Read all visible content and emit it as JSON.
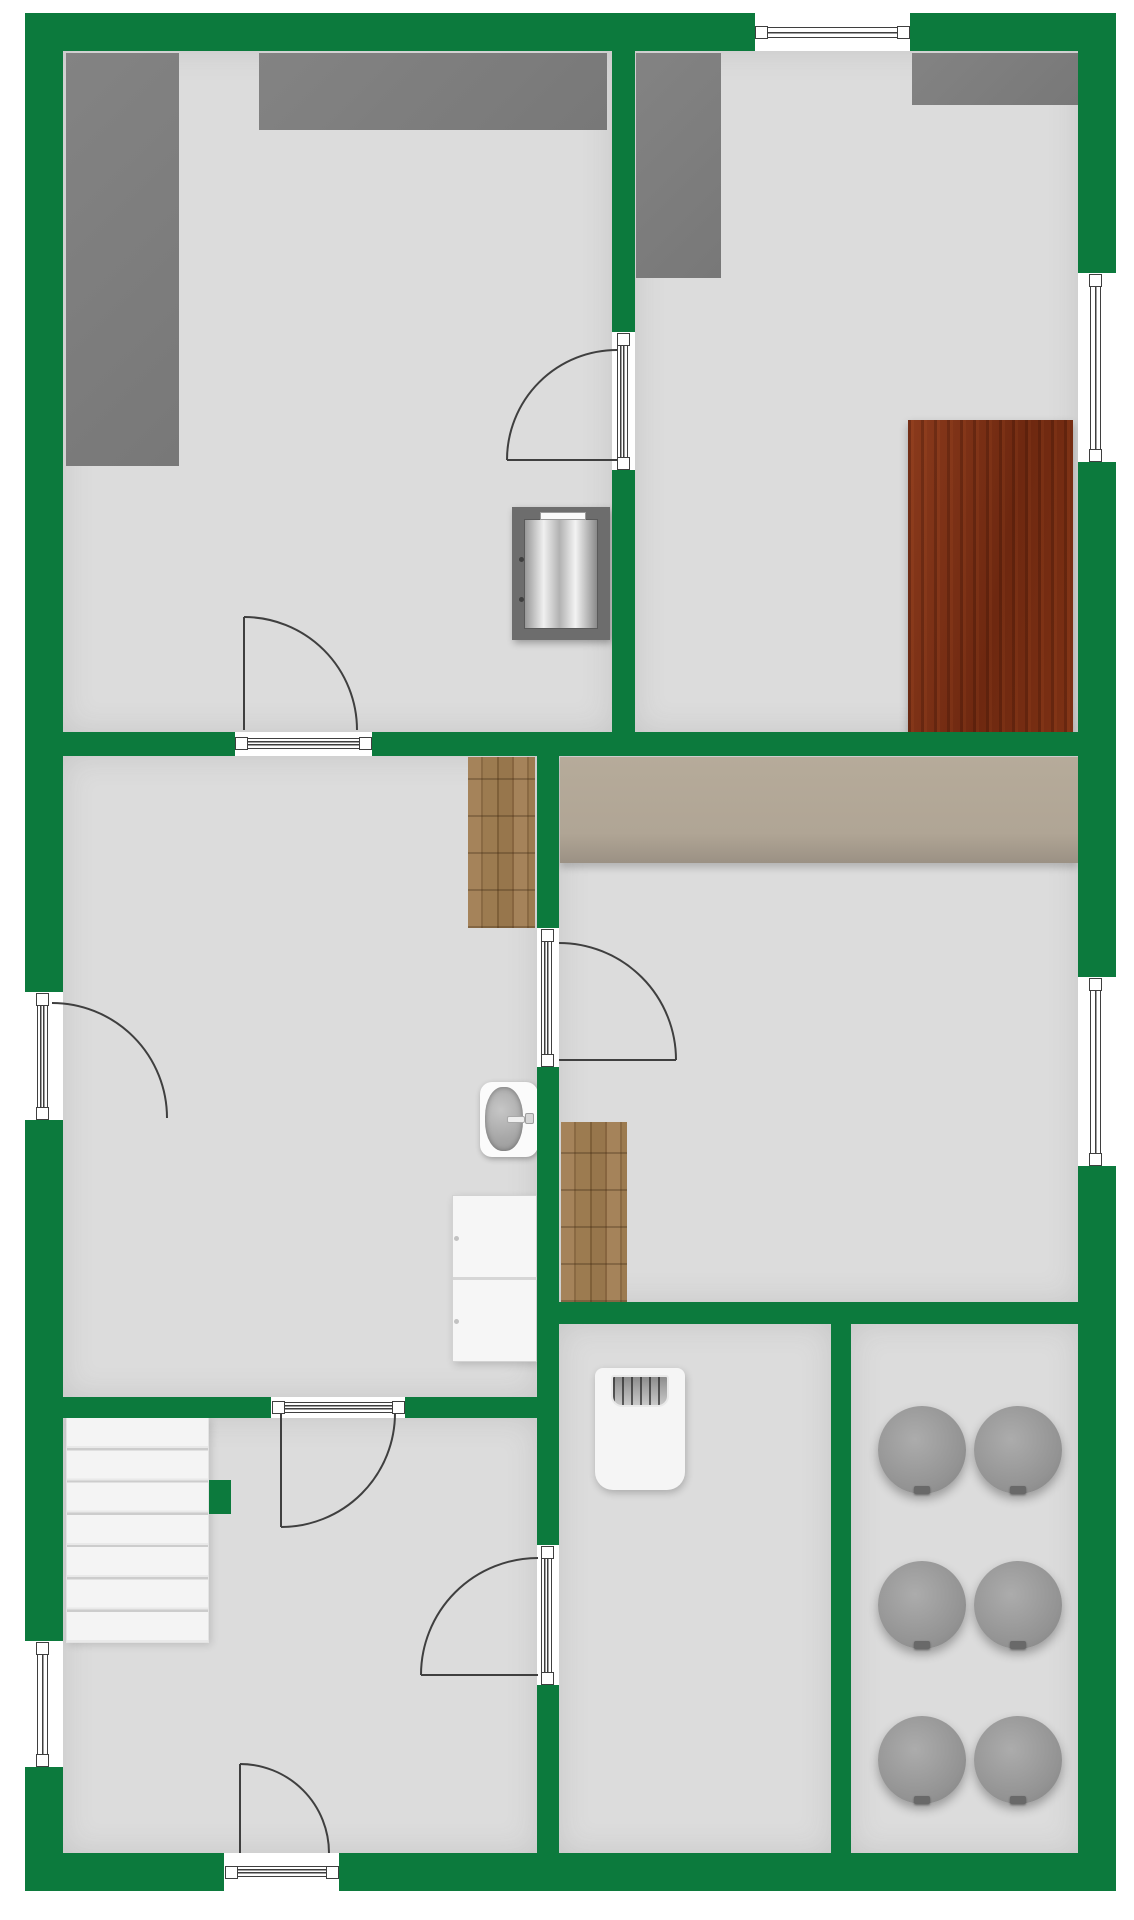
{
  "canvas": {
    "width": 1134,
    "height": 1920,
    "background": "#ffffff"
  },
  "colors": {
    "wall": "#0c7a3d",
    "floor": "#dcdcdc",
    "line": "#3f3f3f",
    "counter_gray": "#7b7b7b",
    "worktop_beige": "#b3a897",
    "wood_floor": "#9a7a50",
    "table_mahogany": "#7c2f14",
    "stool_gray": "#9a9a9a",
    "stairs_white": "#f2f2f2"
  },
  "rooms": [
    {
      "name": "room-top-left-floor",
      "x": 63,
      "y": 51,
      "w": 549,
      "h": 681
    },
    {
      "name": "room-top-right-floor",
      "x": 635,
      "y": 51,
      "w": 443,
      "h": 681
    },
    {
      "name": "room-middle-left-floor",
      "x": 63,
      "y": 756,
      "w": 474,
      "h": 641
    },
    {
      "name": "room-middle-right-floor",
      "x": 559,
      "y": 756,
      "w": 519,
      "h": 546
    },
    {
      "name": "room-bottom-left-floor",
      "x": 63,
      "y": 1418,
      "w": 474,
      "h": 435
    },
    {
      "name": "room-bottom-middle-floor",
      "x": 559,
      "y": 1324,
      "w": 272,
      "h": 529
    },
    {
      "name": "room-bottom-right-floor",
      "x": 851,
      "y": 1324,
      "w": 227,
      "h": 529
    }
  ],
  "walls": [
    {
      "name": "wall-outer-top",
      "x": 25,
      "y": 13,
      "w": 1091,
      "h": 38
    },
    {
      "name": "wall-outer-left",
      "x": 25,
      "y": 13,
      "w": 38,
      "h": 1878
    },
    {
      "name": "wall-outer-right",
      "x": 1078,
      "y": 13,
      "w": 38,
      "h": 1878
    },
    {
      "name": "wall-outer-bottom",
      "x": 25,
      "y": 1853,
      "w": 1091,
      "h": 38
    },
    {
      "name": "wall-middle-horizontal",
      "x": 63,
      "y": 732,
      "w": 1015,
      "h": 24
    },
    {
      "name": "wall-divider-top",
      "x": 612,
      "y": 51,
      "w": 23,
      "h": 681
    },
    {
      "name": "wall-divider-middle",
      "x": 537,
      "y": 756,
      "w": 22,
      "h": 1097
    },
    {
      "name": "wall-lower-left-horizontal",
      "x": 63,
      "y": 1397,
      "w": 474,
      "h": 21
    },
    {
      "name": "wall-lower-right-horizontal",
      "x": 559,
      "y": 1302,
      "w": 519,
      "h": 22
    },
    {
      "name": "wall-bottom-divider",
      "x": 831,
      "y": 1324,
      "w": 20,
      "h": 529
    },
    {
      "name": "wall-stair-stub",
      "x": 209,
      "y": 1480,
      "w": 22,
      "h": 34
    }
  ],
  "openings": [
    {
      "name": "window-top-wall",
      "kind": "window",
      "gap": [
        755,
        13,
        155,
        38
      ],
      "band": [
        755,
        27,
        155,
        11
      ],
      "posts": [
        [
          755,
          26
        ],
        [
          897,
          26
        ]
      ]
    },
    {
      "name": "window-right-wall-upper",
      "kind": "window",
      "gap": [
        1078,
        273,
        38,
        189
      ],
      "band": [
        1090,
        274,
        11,
        187
      ],
      "posts": [
        [
          1089,
          274
        ],
        [
          1089,
          449
        ]
      ]
    },
    {
      "name": "window-right-wall-lower",
      "kind": "window",
      "gap": [
        1078,
        977,
        38,
        189
      ],
      "band": [
        1090,
        978,
        11,
        187
      ],
      "posts": [
        [
          1089,
          978
        ],
        [
          1089,
          1153
        ]
      ]
    },
    {
      "name": "window-left-wall-lower",
      "kind": "window",
      "gap": [
        25,
        1641,
        38,
        126
      ],
      "band": [
        37,
        1642,
        11,
        124
      ],
      "posts": [
        [
          36,
          1642
        ],
        [
          36,
          1754
        ]
      ]
    },
    {
      "name": "door-window-left-wall",
      "kind": "door",
      "gap": [
        25,
        992,
        38,
        128
      ],
      "band": [
        37,
        993,
        11,
        126
      ],
      "posts": [
        [
          36,
          993
        ],
        [
          36,
          1107
        ]
      ],
      "arc": "M52,1003 A115,115 0 0 1 167,1118"
    },
    {
      "name": "door-top-divider",
      "kind": "door",
      "gap": [
        612,
        332,
        23,
        138
      ],
      "band": [
        617,
        334,
        11,
        134
      ],
      "posts": [
        [
          617,
          333
        ],
        [
          617,
          457
        ]
      ],
      "arc": "M507,460 A110,110 0 0 1 617,350",
      "leaf": "M617,460 L507,460"
    },
    {
      "name": "door-middle-wall",
      "kind": "door",
      "gap": [
        235,
        732,
        137,
        24
      ],
      "band": [
        237,
        738,
        133,
        11
      ],
      "posts": [
        [
          235,
          737
        ],
        [
          359,
          737
        ]
      ],
      "arc": "M244,617 A113,113 0 0 1 357,730",
      "leaf": "M244,730 L244,617"
    },
    {
      "name": "door-middle-divider-upper",
      "kind": "door",
      "gap": [
        537,
        928,
        22,
        139
      ],
      "band": [
        541,
        930,
        11,
        135
      ],
      "posts": [
        [
          541,
          929
        ],
        [
          541,
          1054
        ]
      ],
      "arc": "M559,943 A117,117 0 0 1 676,1060",
      "leaf": "M559,1060 L676,1060"
    },
    {
      "name": "door-middle-divider-lower",
      "kind": "door",
      "gap": [
        537,
        1545,
        22,
        140
      ],
      "band": [
        541,
        1547,
        11,
        136
      ],
      "posts": [
        [
          541,
          1546
        ],
        [
          541,
          1672
        ]
      ],
      "arc": "M538,1558 A117,117 0 0 0 421,1675",
      "leaf": "M538,1675 L421,1675"
    },
    {
      "name": "door-lower-left-wall",
      "kind": "door",
      "gap": [
        271,
        1397,
        134,
        21
      ],
      "band": [
        273,
        1402,
        130,
        11
      ],
      "posts": [
        [
          272,
          1401
        ],
        [
          392,
          1401
        ]
      ],
      "arc": "M281,1527 A114,114 0 0 0 395,1413",
      "leaf": "M281,1413 L281,1527"
    },
    {
      "name": "door-bottom-wall-entrance",
      "kind": "door",
      "gap": [
        224,
        1853,
        115,
        38
      ],
      "band": [
        226,
        1866,
        111,
        11
      ],
      "posts": [
        [
          225,
          1866
        ],
        [
          326,
          1866
        ]
      ],
      "arc": "M240,1764 A89,89 0 0 1 329,1853",
      "leaf": "M240,1853 L240,1764"
    }
  ],
  "furniture": [
    {
      "name": "counter-top-left-vertical",
      "type": "counter",
      "x": 66,
      "y": 53,
      "w": 113,
      "h": 413
    },
    {
      "name": "counter-top-left-horizontal",
      "type": "counter",
      "x": 259,
      "y": 53,
      "w": 348,
      "h": 77
    },
    {
      "name": "counter-top-right-vertical",
      "type": "counter",
      "x": 636,
      "y": 53,
      "w": 85,
      "h": 225
    },
    {
      "name": "counter-top-right-horizontal",
      "type": "counter",
      "x": 912,
      "y": 53,
      "w": 166,
      "h": 52
    },
    {
      "name": "dining-table",
      "type": "table",
      "x": 908,
      "y": 420,
      "w": 165,
      "h": 312
    },
    {
      "name": "stove",
      "type": "stove",
      "x": 512,
      "y": 507,
      "w": 98,
      "h": 133
    },
    {
      "name": "worktop-beige",
      "type": "beige",
      "x": 560,
      "y": 757,
      "w": 518,
      "h": 106
    },
    {
      "name": "wood-floor-strip-upper",
      "type": "wood",
      "x": 468,
      "y": 757,
      "w": 67,
      "h": 171
    },
    {
      "name": "wood-floor-strip-lower",
      "type": "wood",
      "x": 561,
      "y": 1122,
      "w": 66,
      "h": 180
    },
    {
      "name": "wash-basin",
      "type": "sink",
      "x": 480,
      "y": 1082,
      "w": 58,
      "h": 75
    },
    {
      "name": "cabinet",
      "type": "cabinet",
      "x": 452,
      "y": 1195,
      "w": 85,
      "h": 167
    },
    {
      "name": "staircase",
      "type": "stairs",
      "x": 66,
      "y": 1417,
      "w": 143,
      "h": 226
    },
    {
      "name": "water-heater",
      "type": "heater",
      "x": 595,
      "y": 1368,
      "w": 90,
      "h": 122
    }
  ],
  "stools": {
    "radius": 44,
    "items": [
      {
        "cx": 922,
        "cy": 1450
      },
      {
        "cx": 1018,
        "cy": 1450
      },
      {
        "cx": 922,
        "cy": 1605
      },
      {
        "cx": 1018,
        "cy": 1605
      },
      {
        "cx": 922,
        "cy": 1760
      },
      {
        "cx": 1018,
        "cy": 1760
      }
    ]
  }
}
